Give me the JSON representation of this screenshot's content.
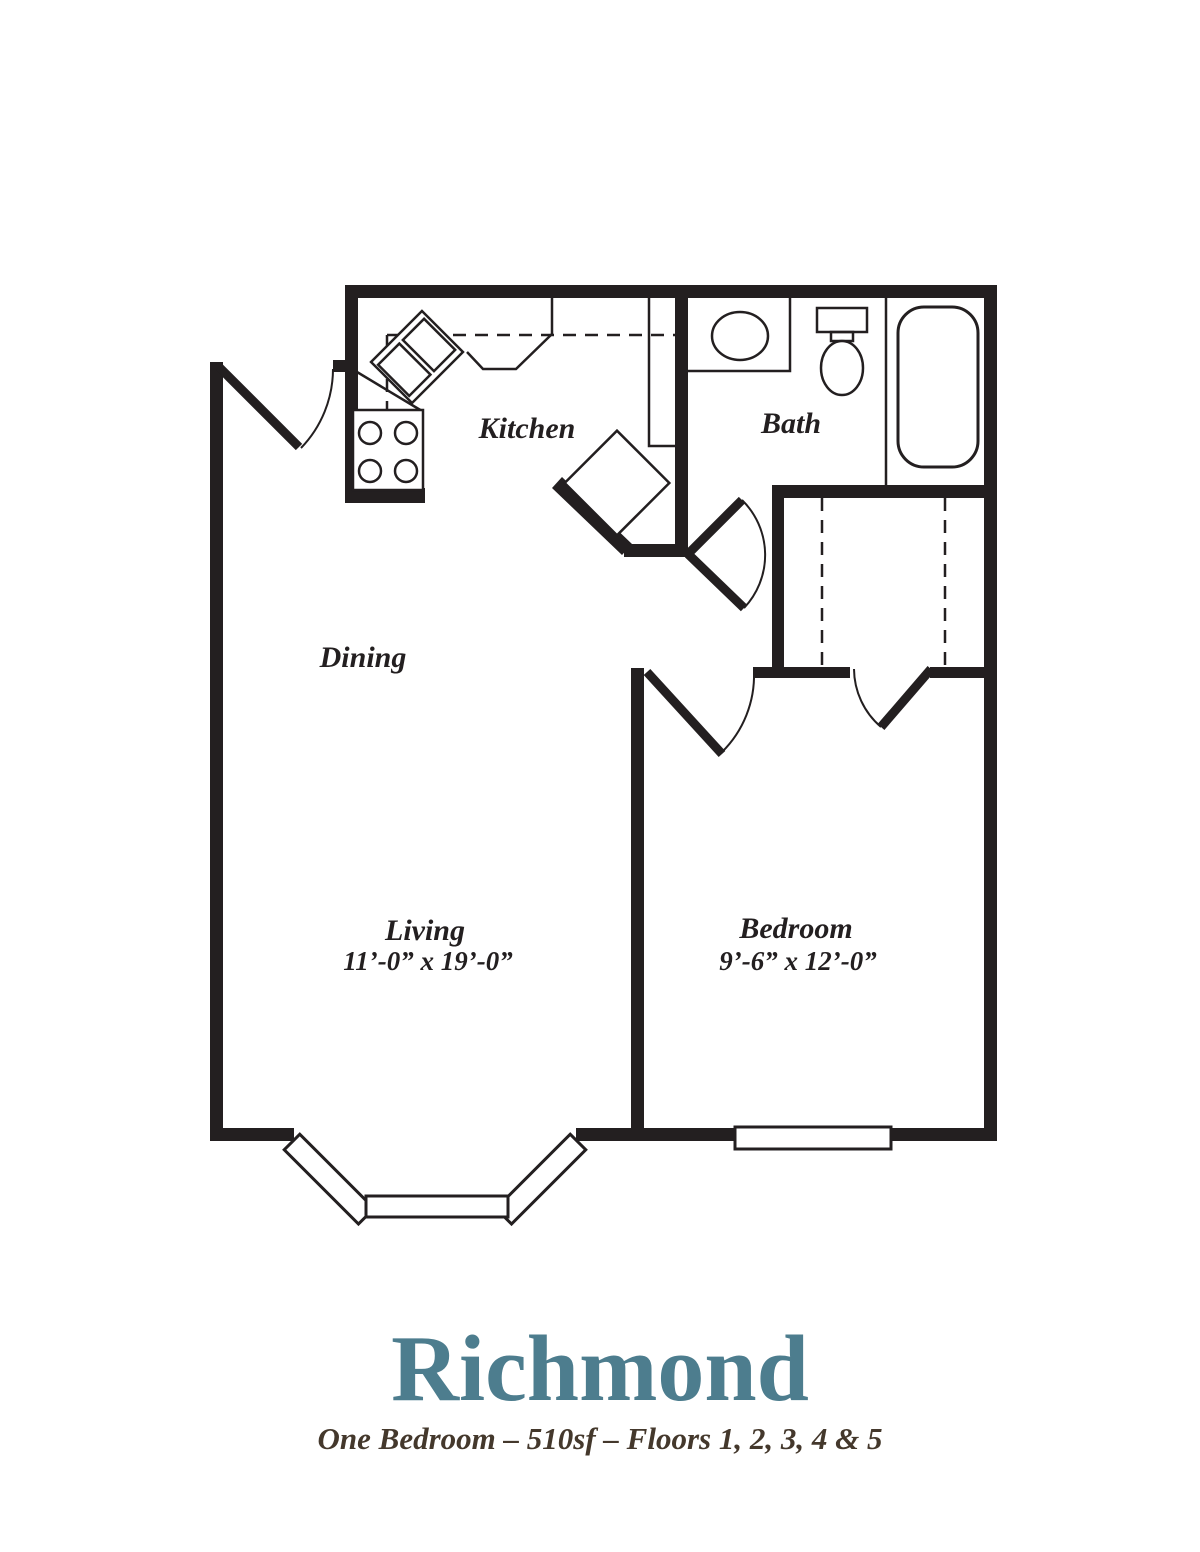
{
  "document": {
    "type": "apartment floor plan"
  },
  "colors": {
    "line": "#231f20",
    "title": "#4d7d8e",
    "subtitle": "#44382c",
    "background": "#ffffff"
  },
  "rooms": {
    "kitchen": {
      "label": "Kitchen"
    },
    "bath": {
      "label": "Bath"
    },
    "dining": {
      "label": "Dining"
    },
    "living": {
      "label": "Living",
      "dims": "11’-0” x 19’-0”"
    },
    "bedroom": {
      "label": "Bedroom",
      "dims": "9’-6” x 12’-0”"
    }
  },
  "titleBlock": {
    "name": "Richmond",
    "subtitle": "One Bedroom – 510sf – Floors 1, 2, 3, 4 & 5"
  },
  "fixtures": [
    "range-stove",
    "double-sink",
    "tall-cabinet",
    "vanity-sink",
    "toilet",
    "bathtub",
    "closet-rods",
    "bay-window",
    "bedroom-window"
  ]
}
